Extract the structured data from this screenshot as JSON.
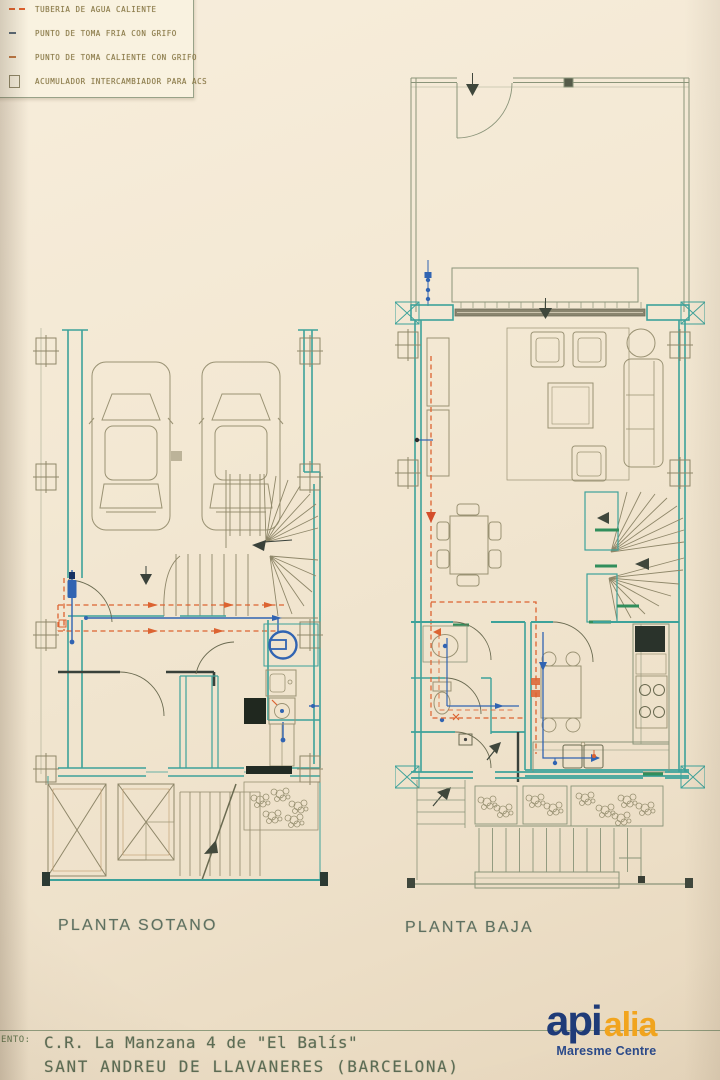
{
  "colors": {
    "paper": "#f2e7d2",
    "legend_paper": "#f9f2e0",
    "wall_teal": "#3aa39b",
    "wall_dark": "#39413a",
    "furniture_olive": "#9a9272",
    "site_olive": "#8a9478",
    "accent_green": "#2e8f5b",
    "hot_water_orange": "#e0622e",
    "cold_water_blue": "#2f64b5",
    "label_green": "#5e7060",
    "legend_text": "#8a7a48",
    "logo_navy": "#1f3b78",
    "logo_orange": "#f2a51e"
  },
  "legend": {
    "items": [
      {
        "symbol": "hot-water-pipe-symbol",
        "label": "TUBERIA DE AGUA CALIENTE"
      },
      {
        "symbol": "cold-tap-symbol",
        "label": "PUNTO DE TOMA FRIA CON GRIFO"
      },
      {
        "symbol": "hot-tap-symbol",
        "label": "PUNTO DE TOMA CALIENTE CON GRIFO"
      },
      {
        "symbol": "accumulator-symbol",
        "label": "ACUMULADOR INTERCAMBIADOR PARA ACS"
      }
    ]
  },
  "plans": {
    "sotano": {
      "label": "PLANTA SOTANO"
    },
    "baja": {
      "label": "PLANTA BAJA"
    }
  },
  "title_block": {
    "field_label": "ENTO:",
    "line1": "C.R. La Manzana 4 de \"El Balís\"",
    "line2": "SANT ANDREU DE LLAVANERES (BARCELONA)"
  },
  "logo": {
    "part1": "api",
    "part2": "alia",
    "subtitle": "Maresme Centre"
  }
}
